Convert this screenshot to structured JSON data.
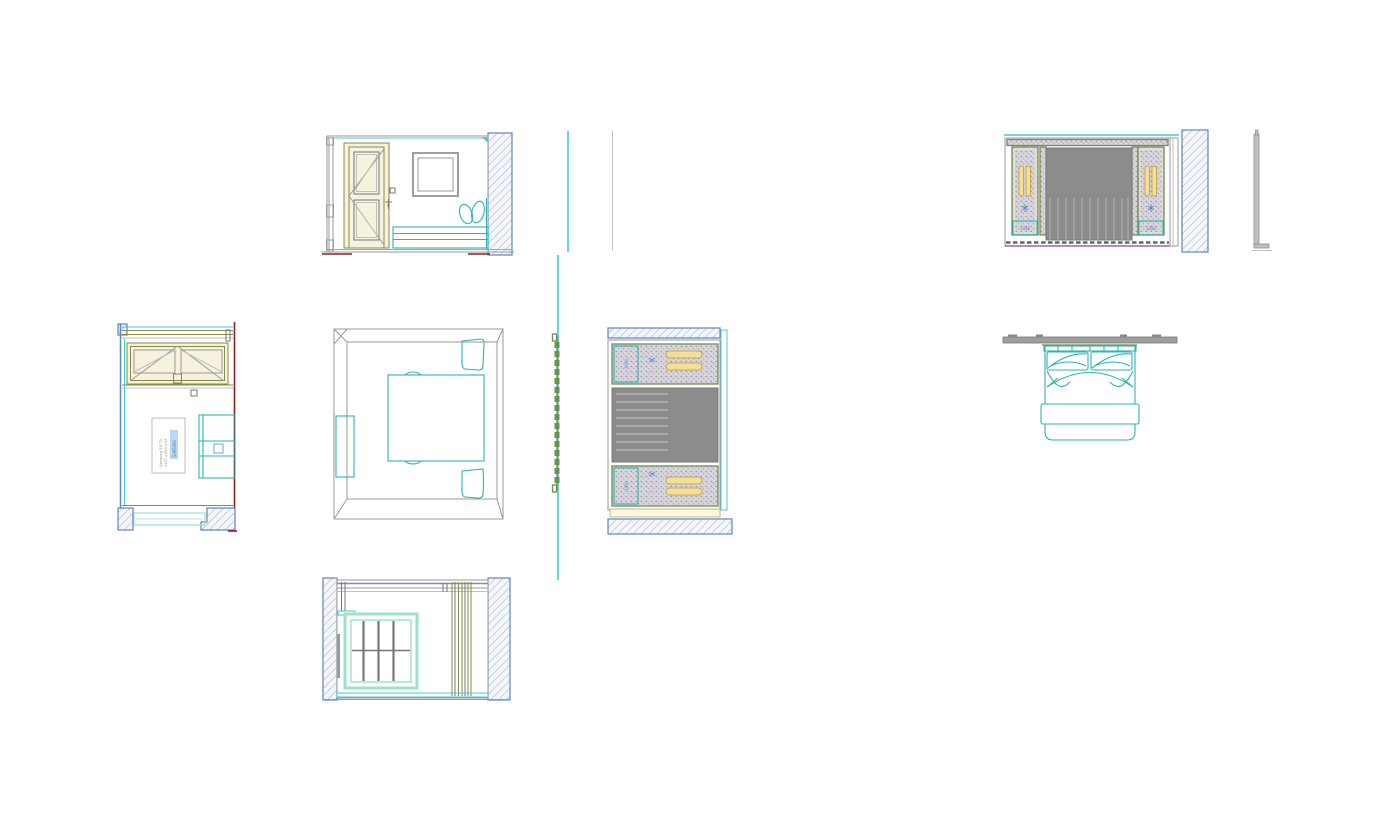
{
  "canvas": {
    "width": 1389,
    "height": 828,
    "background": "#ffffff"
  },
  "palette": {
    "section_cyan": "#49c8d6",
    "furniture_teal": "#2fb3b3",
    "joinery_olive": "#8a8a4a",
    "panel_green": "#6e8f4e",
    "wall_hatch_blue": "#5e86c1",
    "upholstery_gray": "#8c8c8c",
    "light_gold": "#f2df9a",
    "annotation_blue": "#4d8fd1",
    "datum_red": "#8b2020",
    "trim_purple": "#7a4e8f",
    "window_mint": "#9be3c4",
    "line_gray": "#9a9a9a"
  },
  "annotations": {
    "tv_note_line1": "Samsung 50' TV",
    "tv_note_line2": "1127 x 650 x 45",
    "tv_note_highlight": "SAMSUNG",
    "headboard_left_dim": "1350",
    "headboard_right_dim": "1350",
    "side_panel_top_dim": "1350",
    "side_panel_bottom_dim": "1350"
  }
}
